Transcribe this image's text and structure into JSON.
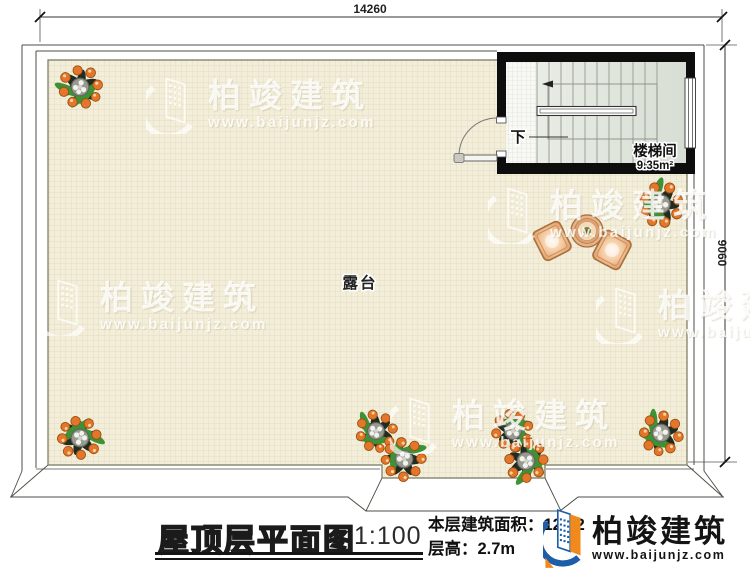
{
  "dimensions": {
    "top_width": "14260",
    "right_height": "9060"
  },
  "plan": {
    "terrace_label": "露台",
    "stair_room_label": "楼梯间",
    "stair_room_area": "9.35m²",
    "stair_direction": "下"
  },
  "watermark": {
    "name": "柏竣建筑",
    "url": "www.baijunjz.com"
  },
  "title_block": {
    "title": "屋顶层平面图",
    "scale": "1:100",
    "area_label": "本层建筑面积：",
    "area_value": "12.62",
    "height_label": "层高：",
    "height_value": "2.7m"
  },
  "logo": {
    "name": "柏竣建筑",
    "url": "www.baijunjz.com"
  }
}
